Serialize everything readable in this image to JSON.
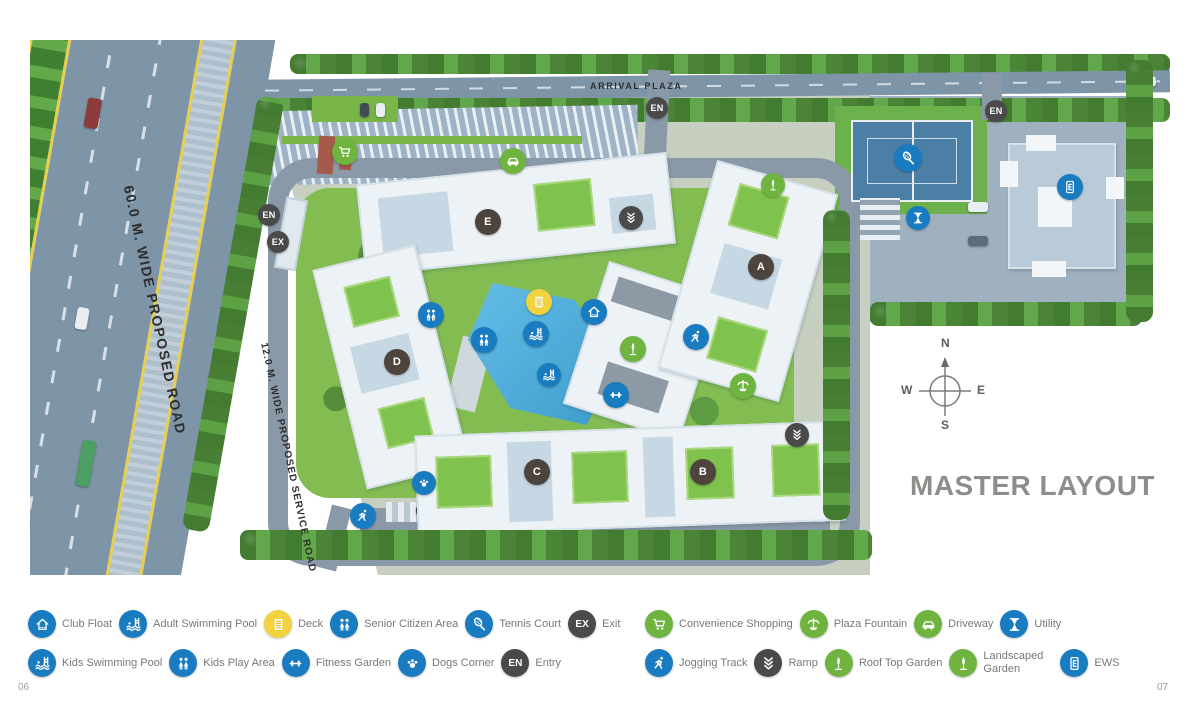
{
  "page": {
    "number_left": "06",
    "number_right": "07"
  },
  "map": {
    "title": "MASTER LAYOUT",
    "labels": {
      "arrival_plaza": "ARRIVAL PLAZA",
      "main_road": "60.0 M. WIDE PROPOSED ROAD",
      "service_road": "12.0 M. WIDE PROPOSED SERVICE ROAD"
    },
    "compass": {
      "north": "N",
      "south": "S",
      "east": "E",
      "west": "W"
    },
    "markers": [
      {
        "name": "entry-marker-top",
        "text": "EN",
        "color": "dark",
        "x": 627,
        "y": 68,
        "size": 22
      },
      {
        "name": "entry-marker-right",
        "text": "EN",
        "color": "dark",
        "x": 966,
        "y": 71,
        "size": 22
      },
      {
        "name": "entry-marker-left",
        "text": "EN",
        "color": "dark",
        "x": 239,
        "y": 175,
        "size": 22
      },
      {
        "name": "exit-marker-left",
        "text": "EX",
        "color": "dark",
        "x": 248,
        "y": 202,
        "size": 22
      },
      {
        "name": "ramp-marker-top",
        "icon": "chevrons-icon",
        "color": "dark",
        "x": 601,
        "y": 178,
        "size": 24
      },
      {
        "name": "ramp-marker-right",
        "icon": "chevrons-icon",
        "color": "dark",
        "x": 767,
        "y": 395,
        "size": 24
      },
      {
        "name": "tower-e-badge",
        "text": "E",
        "color": "tower",
        "x": 458,
        "y": 182,
        "size": 26
      },
      {
        "name": "tower-a-badge",
        "text": "A",
        "color": "tower",
        "x": 731,
        "y": 227,
        "size": 26
      },
      {
        "name": "tower-d-badge",
        "text": "D",
        "color": "tower",
        "x": 367,
        "y": 322,
        "size": 26
      },
      {
        "name": "tower-c-badge",
        "text": "C",
        "color": "tower",
        "x": 507,
        "y": 432,
        "size": 26
      },
      {
        "name": "tower-b-badge",
        "text": "B",
        "color": "tower",
        "x": 673,
        "y": 432,
        "size": 26
      },
      {
        "name": "deck-marker",
        "icon": "deck-icon",
        "color": "yellow",
        "x": 509,
        "y": 262,
        "size": 26
      },
      {
        "name": "club-float-marker",
        "icon": "house-icon",
        "color": "blue",
        "x": 564,
        "y": 272,
        "size": 26
      },
      {
        "name": "adult-swimming-pool-marker",
        "icon": "pool-icon",
        "color": "blue",
        "x": 506,
        "y": 294,
        "size": 26
      },
      {
        "name": "kids-swimming-pool-marker",
        "icon": "pool-icon",
        "color": "blue",
        "x": 519,
        "y": 335,
        "size": 24
      },
      {
        "name": "senior-citizen-area-marker",
        "icon": "people-icon",
        "color": "blue",
        "x": 401,
        "y": 275,
        "size": 26
      },
      {
        "name": "kids-play-area-marker",
        "icon": "people-icon",
        "color": "blue",
        "x": 454,
        "y": 300,
        "size": 26
      },
      {
        "name": "fitness-garden-marker",
        "icon": "dumbbell-icon",
        "color": "blue",
        "x": 586,
        "y": 355,
        "size": 26
      },
      {
        "name": "roof-top-garden-marker",
        "icon": "tree-icon",
        "color": "green",
        "x": 603,
        "y": 309,
        "size": 26
      },
      {
        "name": "plaza-fountain-marker",
        "icon": "fountain-icon",
        "color": "green",
        "x": 713,
        "y": 346,
        "size": 26
      },
      {
        "name": "jogging-track-marker-1",
        "icon": "runner-icon",
        "color": "blue",
        "x": 666,
        "y": 297,
        "size": 26
      },
      {
        "name": "jogging-track-marker-2",
        "icon": "runner-icon",
        "color": "blue",
        "x": 333,
        "y": 476,
        "size": 26
      },
      {
        "name": "dogs-corner-marker",
        "icon": "paw-icon",
        "color": "blue",
        "x": 394,
        "y": 443,
        "size": 24
      },
      {
        "name": "landscaped-garden-marker",
        "icon": "tree-icon",
        "color": "green",
        "x": 743,
        "y": 145,
        "size": 24
      },
      {
        "name": "driveway-marker",
        "icon": "car-icon",
        "color": "green",
        "x": 483,
        "y": 121,
        "size": 26
      },
      {
        "name": "convenience-shopping-marker",
        "icon": "cart-icon",
        "color": "green",
        "x": 315,
        "y": 112,
        "size": 26
      },
      {
        "name": "tennis-court-marker",
        "icon": "racket-icon",
        "color": "blue",
        "x": 878,
        "y": 118,
        "size": 28
      },
      {
        "name": "utility-marker",
        "icon": "hourglass-icon",
        "color": "blue",
        "x": 888,
        "y": 178,
        "size": 24
      },
      {
        "name": "ews-marker",
        "icon": "building-icon",
        "color": "blue",
        "x": 1040,
        "y": 147,
        "size": 26
      }
    ]
  },
  "legend": {
    "left_group": {
      "rows": [
        [
          {
            "label": "Club Float",
            "icon": "house-icon",
            "color": "blue"
          },
          {
            "label": "Adult Swimming Pool",
            "icon": "pool-icon",
            "color": "blue"
          },
          {
            "label": "Deck",
            "icon": "deck-icon",
            "color": "yellow"
          },
          {
            "label": "Senior Citizen Area",
            "icon": "people-icon",
            "color": "blue"
          },
          {
            "label": "Tennis Court",
            "icon": "racket-icon",
            "color": "blue"
          },
          {
            "label": "Exit",
            "text": "EX",
            "color": "dark"
          }
        ],
        [
          {
            "label": "Kids Swimming Pool",
            "icon": "pool-icon",
            "color": "blue"
          },
          {
            "label": "Kids Play Area",
            "icon": "people-icon",
            "color": "blue"
          },
          {
            "label": "Fitness Garden",
            "icon": "dumbbell-icon",
            "color": "blue"
          },
          {
            "label": "Dogs Corner",
            "icon": "paw-icon",
            "color": "blue"
          },
          {
            "label": "Entry",
            "text": "EN",
            "color": "dark"
          }
        ]
      ]
    },
    "right_group": {
      "rows": [
        [
          {
            "label": "Convenience Shopping",
            "icon": "cart-icon",
            "color": "green"
          },
          {
            "label": "Plaza Fountain",
            "icon": "fountain-icon",
            "color": "green"
          },
          {
            "label": "Driveway",
            "icon": "car-icon",
            "color": "green"
          },
          {
            "label": "Utility",
            "icon": "hourglass-icon",
            "color": "blue"
          }
        ],
        [
          {
            "label": "Jogging Track",
            "icon": "runner-icon",
            "color": "blue"
          },
          {
            "label": "Ramp",
            "icon": "chevrons-icon",
            "color": "dark"
          },
          {
            "label": "Roof Top Garden",
            "icon": "tree-icon",
            "color": "green"
          },
          {
            "label": "Landscaped Garden",
            "icon": "tree-icon",
            "color": "green",
            "wrap": true
          },
          {
            "label": "EWS",
            "icon": "building-icon",
            "color": "blue"
          }
        ]
      ]
    }
  },
  "colors": {
    "icon_blue": "#1a7cc0",
    "icon_green": "#6fb43f",
    "icon_dark": "#4a4a4a",
    "icon_yellow": "#f2d23e",
    "tower_badge": "#4d443e"
  }
}
